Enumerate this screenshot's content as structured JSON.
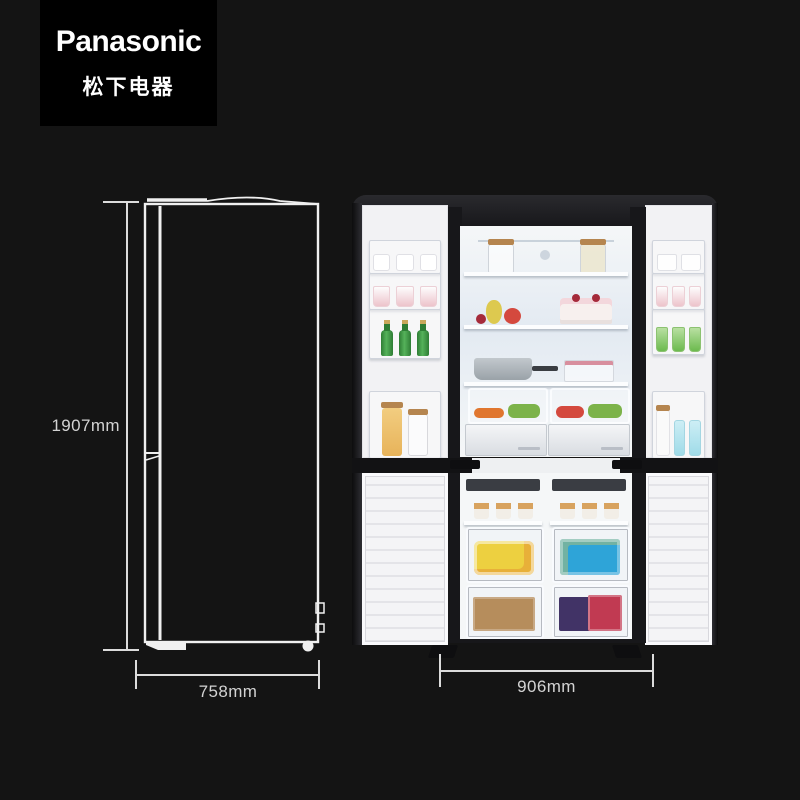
{
  "brand": {
    "name": "Panasonic",
    "cn": "松下电器"
  },
  "dimensions": {
    "height": "1907mm",
    "depth": "758mm",
    "width": "906mm"
  },
  "figures": {
    "side_view": "refrigerator side profile line drawing with height and depth dimension lines",
    "front_view": "cross four-door refrigerator shown open and fully stocked, with width dimension line"
  },
  "fridge_contents": {
    "left_door": [
      "white cartons",
      "pink yogurt cups",
      "green glass bottles with gold caps",
      "pasta jar with cork lid",
      "clear jar"
    ],
    "right_door": [
      "glass mugs",
      "pink cans",
      "green printed cups",
      "milk bottle with cork",
      "blue swing-top bottles"
    ],
    "fresh_compartment": [
      "two glass storage jars on top rack",
      "pear, apple and cherries",
      "berry cream cake",
      "stainless saucepan",
      "berry box",
      "two crisper drawers with carrots and greens",
      "two white storage drawers"
    ],
    "freezer": [
      "ice cream cups",
      "yellow frozen-food bag",
      "blue frozen-food box",
      "kraft paper packages",
      "red and purple frozen packages"
    ]
  },
  "colors": {
    "bg": "#141414",
    "logo_bg": "#000000",
    "logo_text": "#ffffff",
    "dim_line": "#dcdcdc",
    "dim_text": "#d3d3d3",
    "outline": "#f0f0f0",
    "door_face": "#f2f2f4",
    "dark_top": "#202024",
    "interior": "#f5f7f8",
    "interior_back": "#e3eaf2",
    "can_pink": "#edc3cb",
    "bottle_green": "#3f9c44",
    "cap_gold": "#c9a85c",
    "cup_green": "#6cba4e",
    "pasta": "#e7b35a",
    "cork": "#b5854f",
    "bottle_blue": "#9fdbe8",
    "pear": "#ddc94f",
    "apple": "#d4493e",
    "cherry": "#a52a3a",
    "pan": "#9aa2a8",
    "carrot": "#e0762f",
    "greens": "#7cb34a",
    "pkg_yellow": "#edd040",
    "pkg_blue": "#2ea4d8",
    "pkg_kraft": "#b68d5c",
    "pkg_red": "#c13a52",
    "pkg_purple": "#413366",
    "cup_tan": "#d8a35f"
  }
}
